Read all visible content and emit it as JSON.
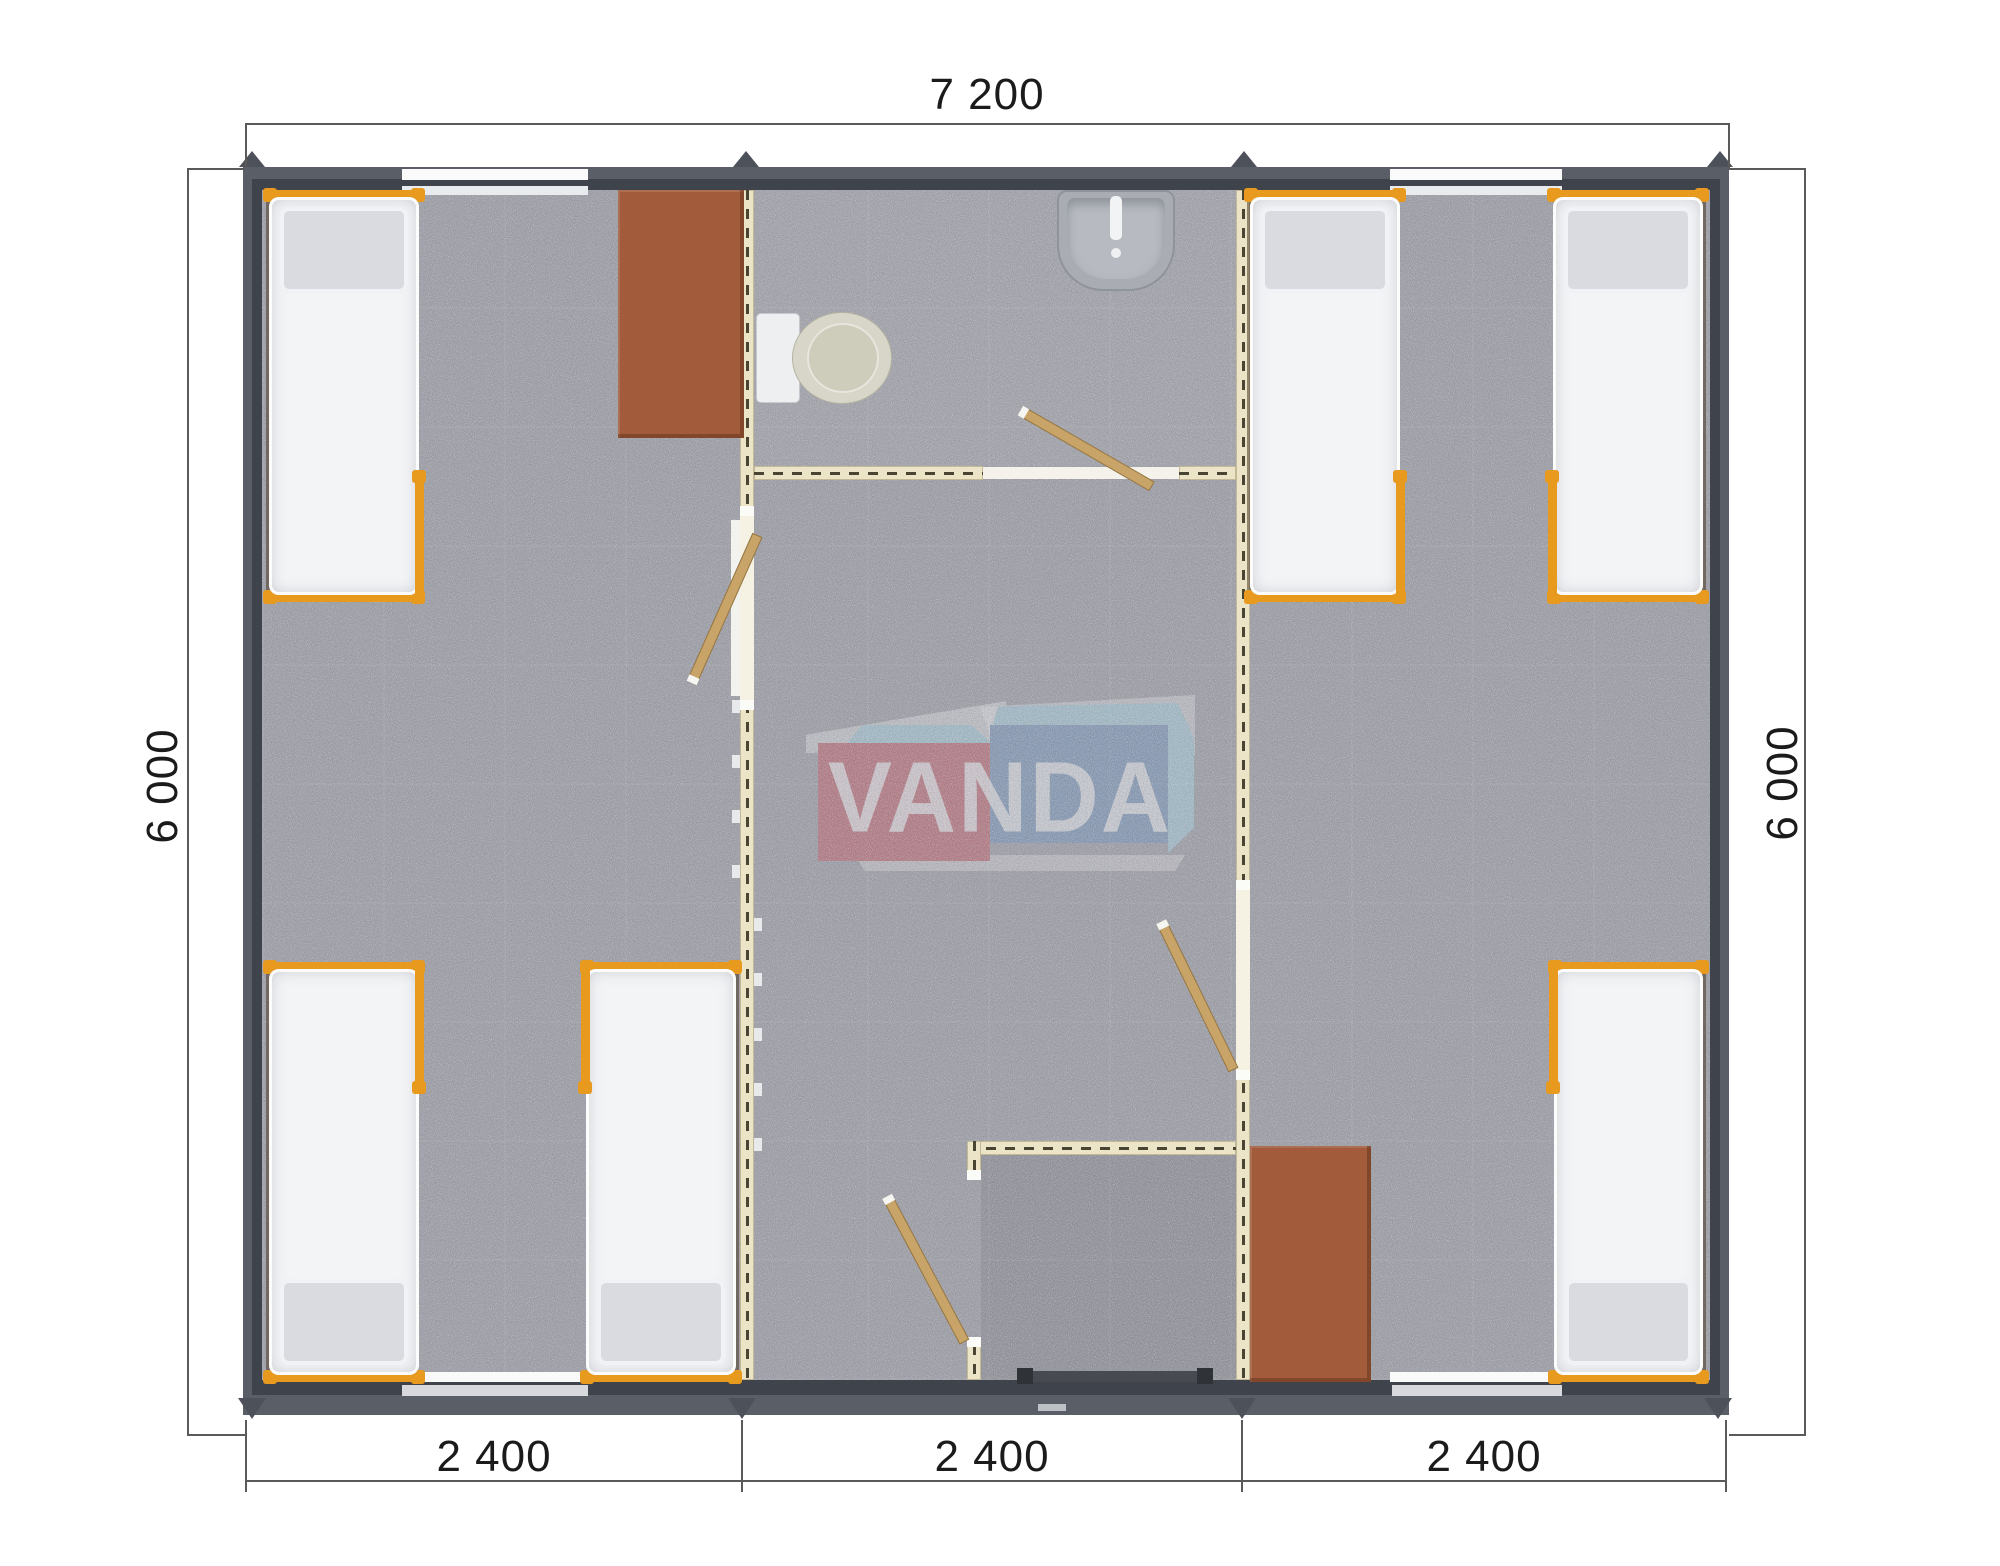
{
  "plan": {
    "watermark_text": "VANDA",
    "dimensions": {
      "top": "7 200",
      "left": "6 000",
      "right": "6 000",
      "bottom": [
        "2 400",
        "2 400",
        "2 400"
      ]
    }
  },
  "colors": {
    "wall_dark": "#3f434b",
    "eave": "#5a5e66",
    "roof_marker": "#4d515a",
    "floor": "#9c9da5",
    "partition": "#ebe4c7",
    "partition_dash": "#4a4433",
    "bed_frame_orange": "#e79a1e",
    "mattress": "#f3f4f6",
    "pillow": "#d9dbe1",
    "desk_brown": "#a25b3b",
    "door_wood": "#c8a468",
    "fixture_gray": "#a9adb3",
    "window_white": "#fafafa",
    "dim_line": "#5a5a5a",
    "dim_text": "#1b1b1b",
    "wm_red": "#c75763",
    "wm_blue": "#7093bc",
    "wm_lightblue": "#a5d4e4"
  }
}
